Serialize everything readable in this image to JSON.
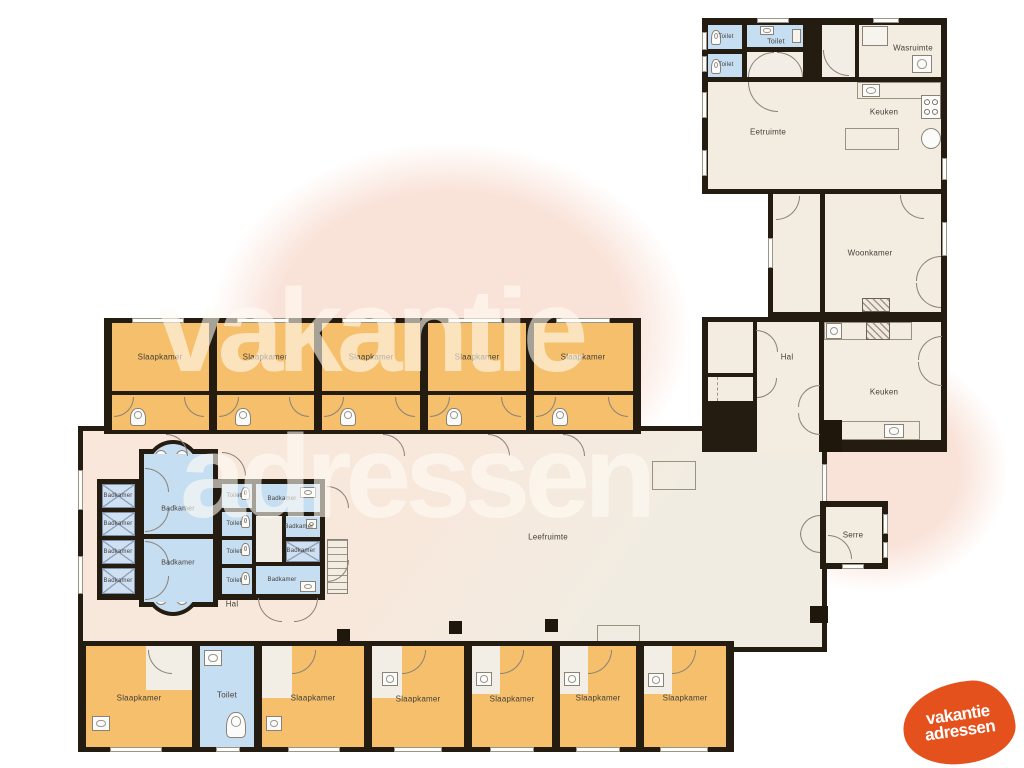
{
  "watermark": {
    "line1": "vakantie",
    "line2": "adressen"
  },
  "logo": {
    "line1": "vakantie",
    "line2": "adressen",
    "color": "#e5511d"
  },
  "colors": {
    "wall": "#251c11",
    "bedroom_fill": "#f5bf6b",
    "wet_room_fill": "#c6def2",
    "living_fill": "#f2ece1",
    "living_pink": "#f8e8dc",
    "watermark_blob": "#f9e2d8",
    "logo_orange": "#e5511d"
  },
  "labels": {
    "slaapkamer": "Slaapkamer",
    "toilet": "Toilet",
    "badkamer": "Badkamer",
    "leefruimte": "Leefruimte",
    "eetruimte": "Eetruimte",
    "keuken": "Keuken",
    "woonkamer": "Woonkamer",
    "wasruimte": "Wasruimte",
    "hal": "Hal",
    "serre": "Serre"
  }
}
